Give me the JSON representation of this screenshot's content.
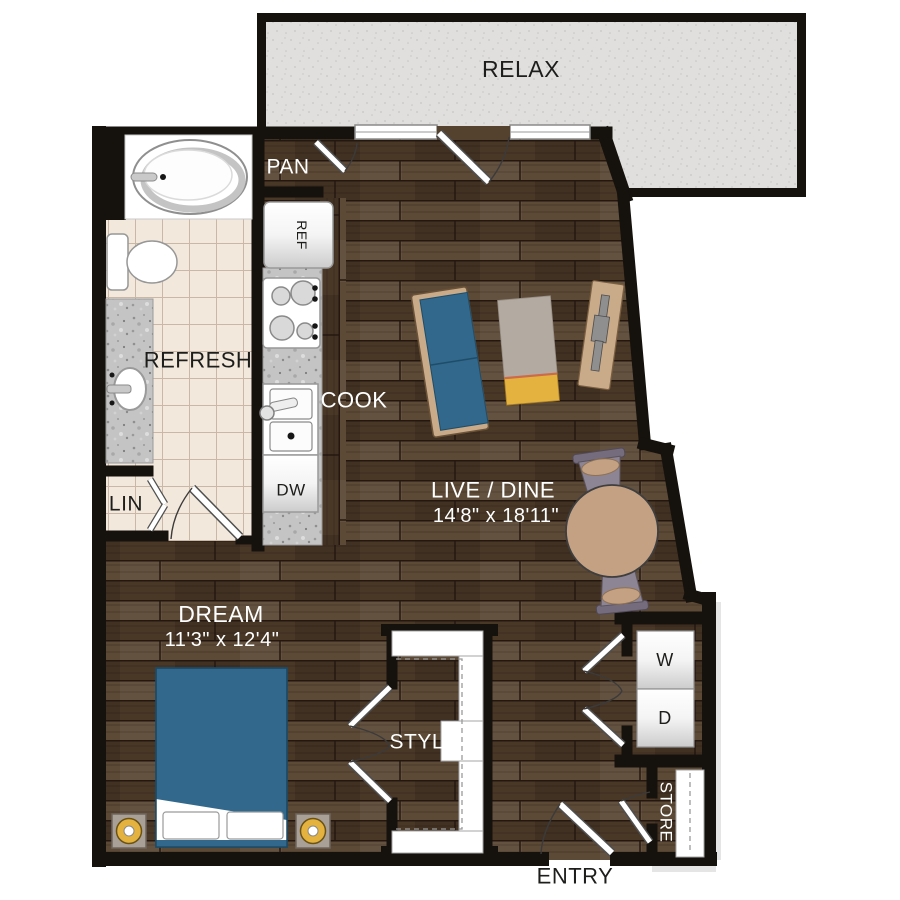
{
  "plan": {
    "rooms": {
      "balcony": {
        "label": "RELAX"
      },
      "pantry": {
        "label": "PAN"
      },
      "bathroom": {
        "label": "REFRESH"
      },
      "kitchen": {
        "label": "COOK"
      },
      "living": {
        "label": "LIVE / DINE",
        "dimensions": "14'8\" x 18'11\""
      },
      "bedroom": {
        "label": "DREAM",
        "dimensions": "11'3\" x 12'4\""
      },
      "closet": {
        "label": "STYLE"
      },
      "linen": {
        "label": "LIN"
      },
      "storage": {
        "label": "STORE"
      },
      "entry": {
        "label": "ENTRY"
      }
    },
    "appliances": {
      "refrigerator": "REF",
      "dishwasher": "DW",
      "washer": "W",
      "dryer": "D"
    },
    "palette": {
      "wall": "#15110c",
      "wood_base": "#54422f",
      "wood_light": "#5c4936",
      "wood_dark": "#4a3827",
      "wood_seam": "#241710",
      "tile": "#f3e8dc",
      "tile_line": "#c9b8a7",
      "granite": "#c4c4c4",
      "balcony": "#e0dfdd",
      "balcony_dot": "#c6c5c3",
      "accent_blue": "#31688b",
      "tan": "#c9aa89",
      "gold": "#e4b23e",
      "rug_gray": "#b3aaa2",
      "chair_gray": "#8d8494",
      "table_tan": "#c4a183",
      "label_light": "#ffffff",
      "label_dark": "#1d1d1b"
    }
  }
}
